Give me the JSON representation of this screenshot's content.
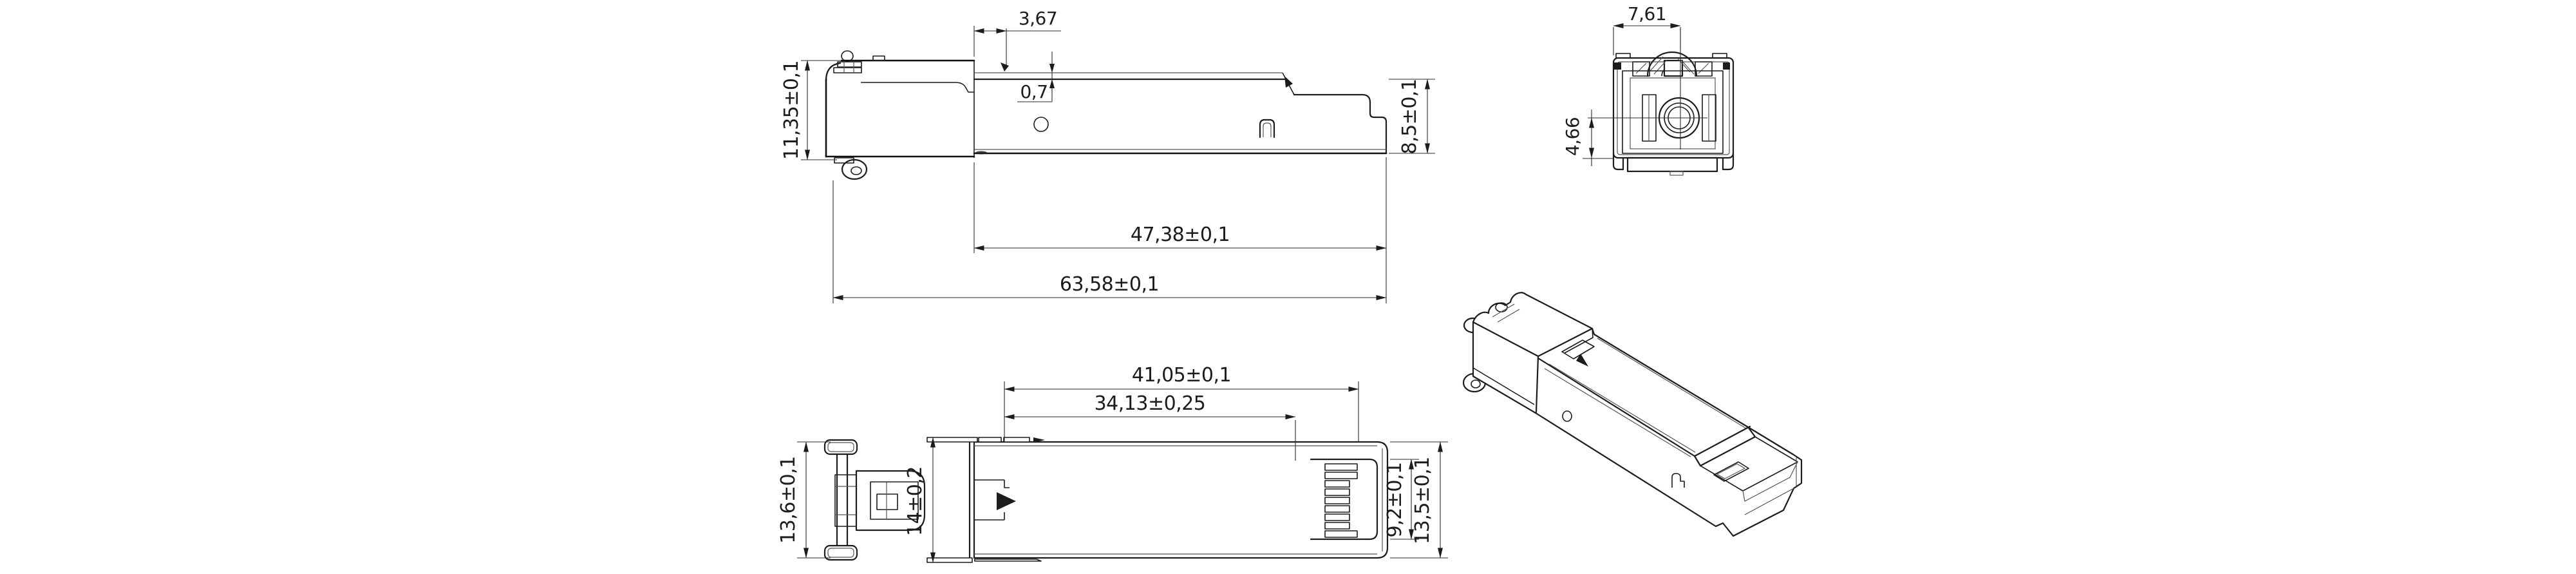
{
  "colors": {
    "background": "#ffffff",
    "line": "#1c1c1c",
    "dimension": "#2a2a2a"
  },
  "views": {
    "side": {
      "dims": {
        "step_offset": "3,67",
        "lip_height": "0,7",
        "front_height": "11,35±0,1",
        "cage_length": "47,38±0,1",
        "overall_length": "63,58±0,1",
        "body_height": "8,5±0,1"
      }
    },
    "front": {
      "dims": {
        "edge_to_center": "7,61",
        "center_to_bottom": "4,66"
      }
    },
    "top": {
      "dims": {
        "length_to_pad_end": "41,05±0,1",
        "length_to_stop": "34,13±0,25",
        "front_width": "13,6±0,1",
        "rail_width": "14±0,2",
        "pad_area_width": "9,2±0,1",
        "rear_width": "13,5±0,1"
      }
    }
  }
}
